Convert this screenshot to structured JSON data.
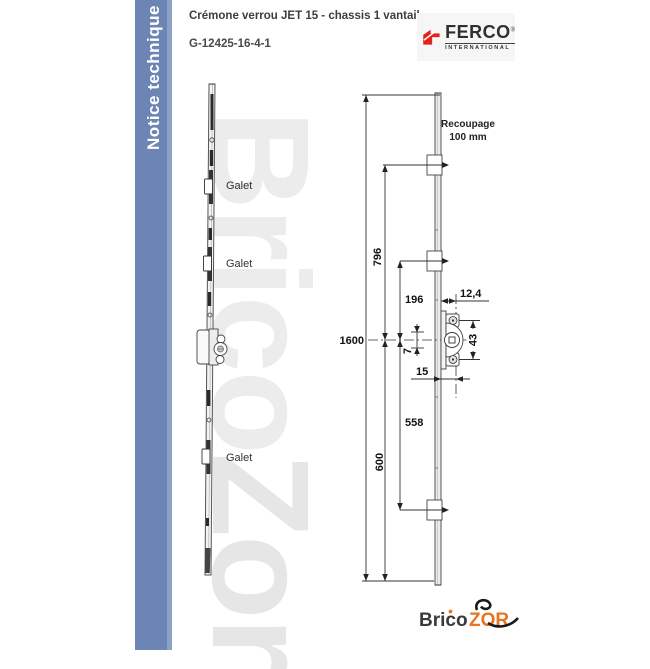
{
  "page": {
    "background": "#ffffff"
  },
  "sidebar": {
    "label": "Notice technique",
    "bg_color": "#6d85b5",
    "text_color": "#ffffff"
  },
  "header": {
    "title": "Crémone verrou JET 15 - chassis 1 vantail",
    "reference": "G-12425-16-4-1",
    "brand": {
      "name": "FERCO",
      "reg": "®",
      "sub": "INTERNATIONAL",
      "accent_color": "#e2231a"
    }
  },
  "watermark": {
    "part1": "Brico",
    "part2": "Zor"
  },
  "left_view": {
    "labels": [
      {
        "text": "Galet"
      },
      {
        "text": "Galet"
      },
      {
        "text": "Galet"
      }
    ]
  },
  "dimensions": {
    "recoupage_line1": "Recoupage",
    "recoupage_line2": "100 mm",
    "d1600": "1600",
    "d796": "796",
    "d600": "600",
    "d196": "196",
    "d558": "558",
    "d124": "12,4",
    "d43": "43",
    "d7": "7",
    "d15": "15"
  },
  "footer_logo": {
    "part1": "Brico",
    "part2": "ZOR",
    "accent_color": "#e87421"
  }
}
